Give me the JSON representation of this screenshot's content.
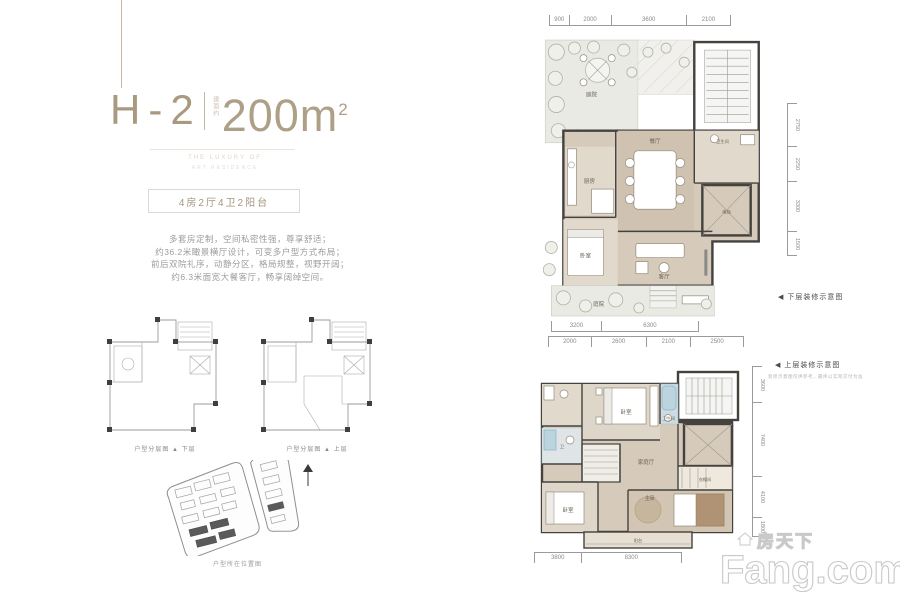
{
  "colors": {
    "accent": "#a8997f",
    "dim_line": "#9b9b9b",
    "floor_beige": "#d6cabb",
    "garden_green": "#e9eae4",
    "bath_blue": "#bcd4de"
  },
  "brand": {
    "cn": "房天下",
    "en": "Fang.com"
  },
  "header": {
    "unit_code": "H-2",
    "area_prefix": "建面约",
    "area_value": "200m",
    "area_sup": "2",
    "tagline_line1": "THE LUXURY OF",
    "tagline_line2": "ART RESIDENCE",
    "badge": "4房2厅4卫2阳台"
  },
  "description": {
    "lines": [
      "多套房定制，空间私密性强，尊享舒适；",
      "约36.2米瞰景横厅设计，可变多户型方式布局；",
      "前后双院礼序，动静分区，格局规整，视野开阔；",
      "约6.3米面宽大餐客厅，畅享阔绰空间。"
    ]
  },
  "mini_plans": {
    "caption": "户型分层图",
    "arrow": "▲",
    "lower_level": "下层",
    "upper_level": "上层"
  },
  "site_plan": {
    "caption": "户型所在位置图"
  },
  "plans": {
    "lower": {
      "label": "◀ 下层装修示意图",
      "dims_top": [
        "900",
        "2000",
        "3600",
        "2100"
      ],
      "dims_right": [
        "2750",
        "2250",
        "3300",
        "1500"
      ],
      "dims_bottom": [
        "3200",
        "6300"
      ],
      "rooms": {
        "garden_top": "庭院",
        "kitchen": "厨房",
        "dining": "餐厅",
        "bath": "卫生间",
        "elevator": "电梯",
        "living": "客厅",
        "bedroom": "卧室",
        "garden_bottom": "庭院"
      }
    },
    "upper": {
      "label": "◀ 上层装修示意图",
      "note": "装修示意图仅供参考，最终以实际交付为准",
      "dims_top": [
        "2000",
        "2600",
        "2100",
        "2500"
      ],
      "dims_right": [
        "3600",
        "7400",
        "4100",
        "1800"
      ],
      "dims_bottom": [
        "3800",
        "8300"
      ],
      "rooms": {
        "bedroom_top": "卧室",
        "bath_top": "卫生间",
        "bath_left": "卫",
        "hall": "家庭厅",
        "closet": "衣帽间",
        "master": "主卧",
        "bedroom_bottom": "卧室",
        "balcony": "阳台"
      }
    }
  }
}
